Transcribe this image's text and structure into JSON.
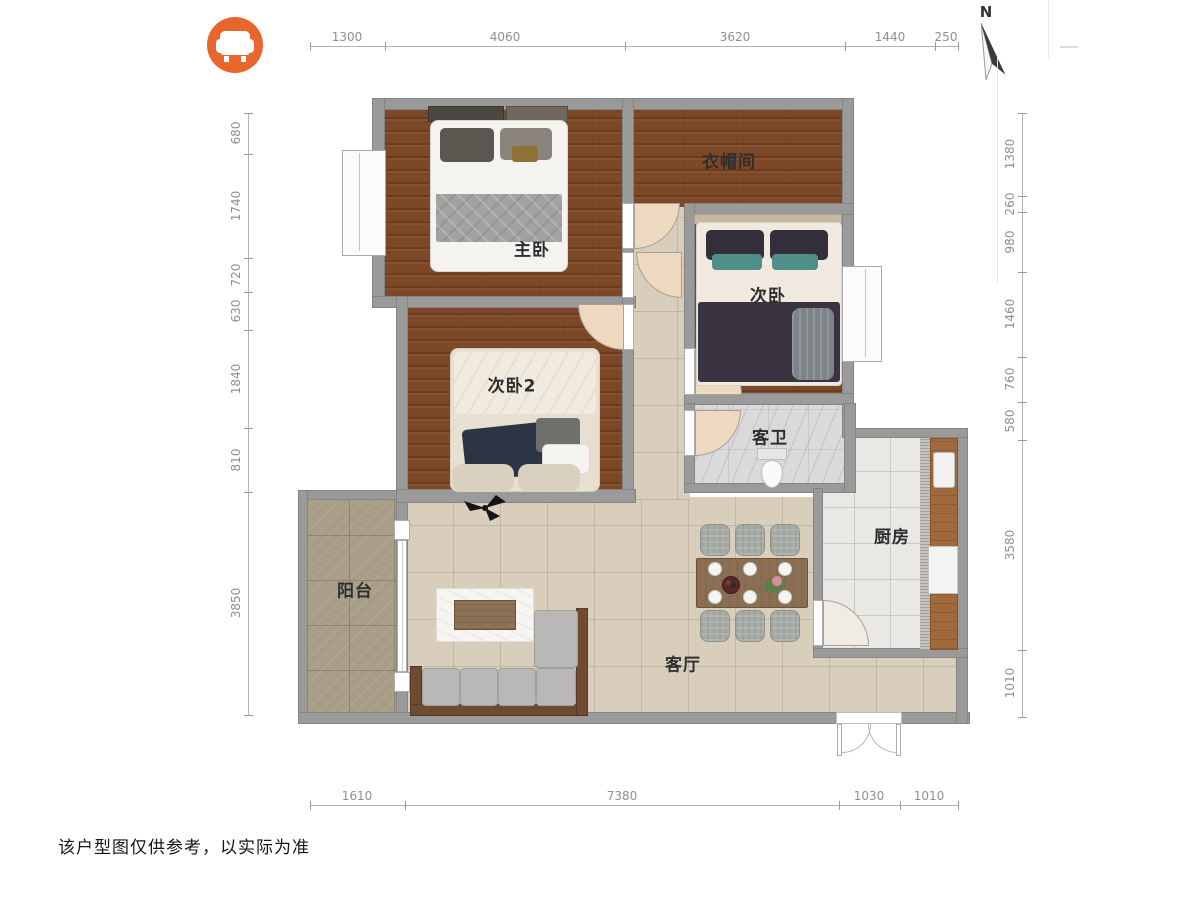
{
  "watermark": {
    "icon": "sofa-armchair",
    "bg_color": "#e8652c"
  },
  "compass": {
    "label": "N"
  },
  "rooms": [
    {
      "id": "master-bedroom",
      "name": "主卧"
    },
    {
      "id": "cloakroom",
      "name": "衣帽间"
    },
    {
      "id": "bedroom-2",
      "name": "次卧"
    },
    {
      "id": "bedroom-3",
      "name": "次卧2"
    },
    {
      "id": "guest-bathroom",
      "name": "客卫"
    },
    {
      "id": "kitchen",
      "name": "厨房"
    },
    {
      "id": "balcony",
      "name": "阳台"
    },
    {
      "id": "living-room",
      "name": "客厅"
    }
  ],
  "dimensions_mm": {
    "top": [
      "1300",
      "4060",
      "3620",
      "1440",
      "250"
    ],
    "left": [
      "680",
      "1740",
      "720",
      "630",
      "1840",
      "810",
      "3850"
    ],
    "right": [
      "1380",
      "260",
      "980",
      "1460",
      "760",
      "580",
      "3580",
      "1010"
    ],
    "bottom": [
      "1610",
      "7380",
      "1030",
      "1010"
    ]
  },
  "footer": {
    "disclaimer": "该户型图仅供参考，以实际为准"
  },
  "palette": {
    "wall": "#9a9a9a",
    "wood_floor": "#7c4827",
    "tile_floor": "#d9cdbb",
    "balcony_floor": "#a89e88",
    "marble_floor": "#dadadc",
    "kitchen_floor": "#e9e8e5",
    "accent_orange": "#e8652c"
  }
}
